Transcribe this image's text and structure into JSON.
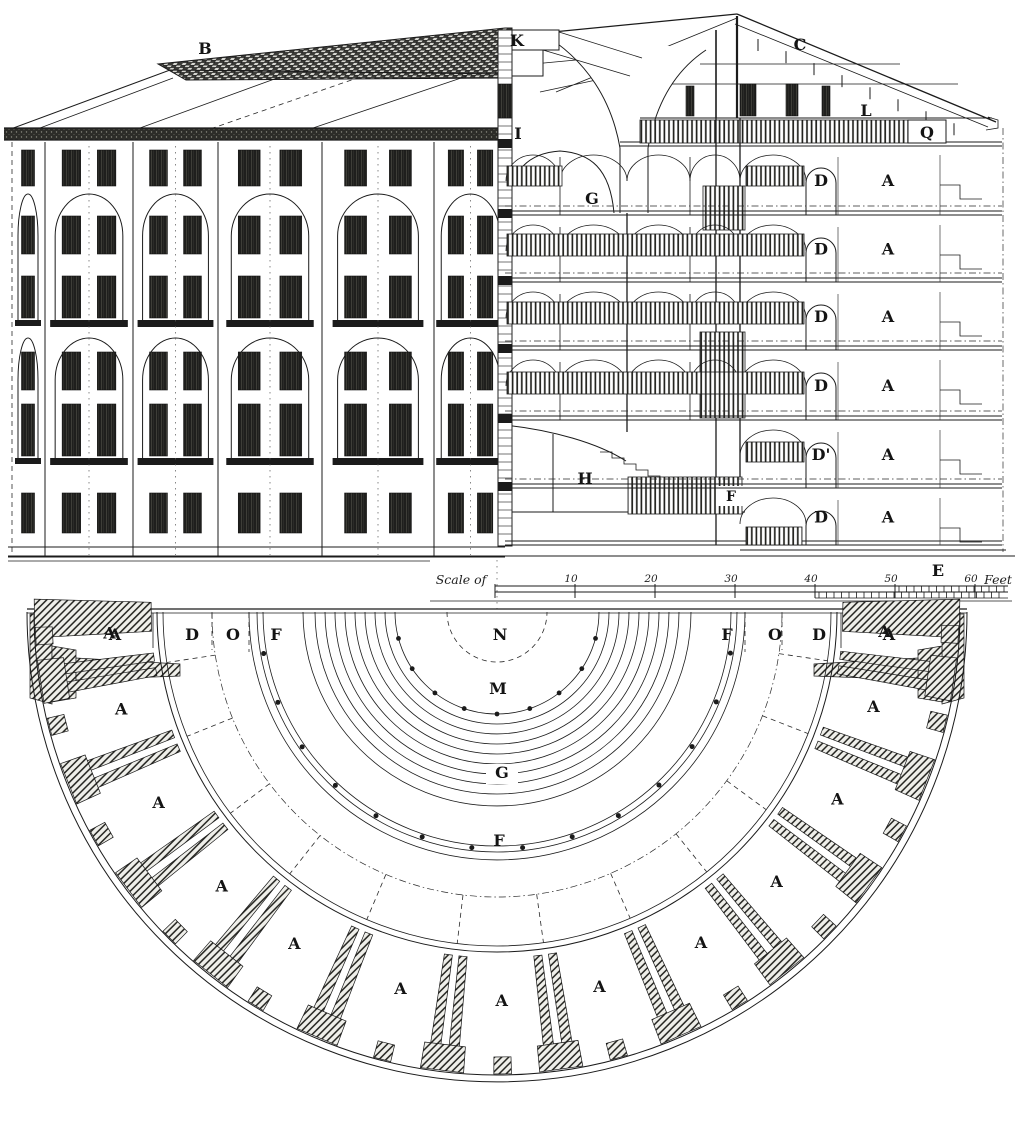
{
  "palette": {
    "ink": "#1b1b1b",
    "paper": "#ffffff"
  },
  "elevation": {
    "roof_label": "B"
  },
  "section": {
    "lantern_label": "K",
    "roof_label": "C",
    "left_wall_label": "I",
    "well_label": "G",
    "attic_left_label": "L",
    "attic_right_label": "Q",
    "floors": [
      {
        "gallery": "D",
        "cell": "A"
      },
      {
        "gallery": "D",
        "cell": "A"
      },
      {
        "gallery": "D",
        "cell": "A"
      },
      {
        "gallery": "D",
        "cell": "A"
      },
      {
        "gallery": "D'",
        "cell": "A"
      },
      {
        "gallery": "D",
        "cell": "A"
      }
    ],
    "hall_label": "H",
    "stair_label": "F",
    "foundation_label": "E"
  },
  "scale_bar": {
    "caption": "Scale of",
    "ticks": [
      "10",
      "20",
      "30",
      "40",
      "50",
      "60"
    ],
    "unit": "Feet"
  },
  "plan": {
    "left_zone_labels": [
      "A",
      "D",
      "O",
      "F"
    ],
    "right_zone_labels": [
      "F",
      "O",
      "D",
      "A"
    ],
    "axis_labels": [
      "N",
      "M",
      "G",
      "F"
    ],
    "cell_labels": [
      "A",
      "A",
      "A",
      "A",
      "A",
      "A",
      "A",
      "A",
      "A",
      "A",
      "A",
      "A",
      "A"
    ]
  }
}
